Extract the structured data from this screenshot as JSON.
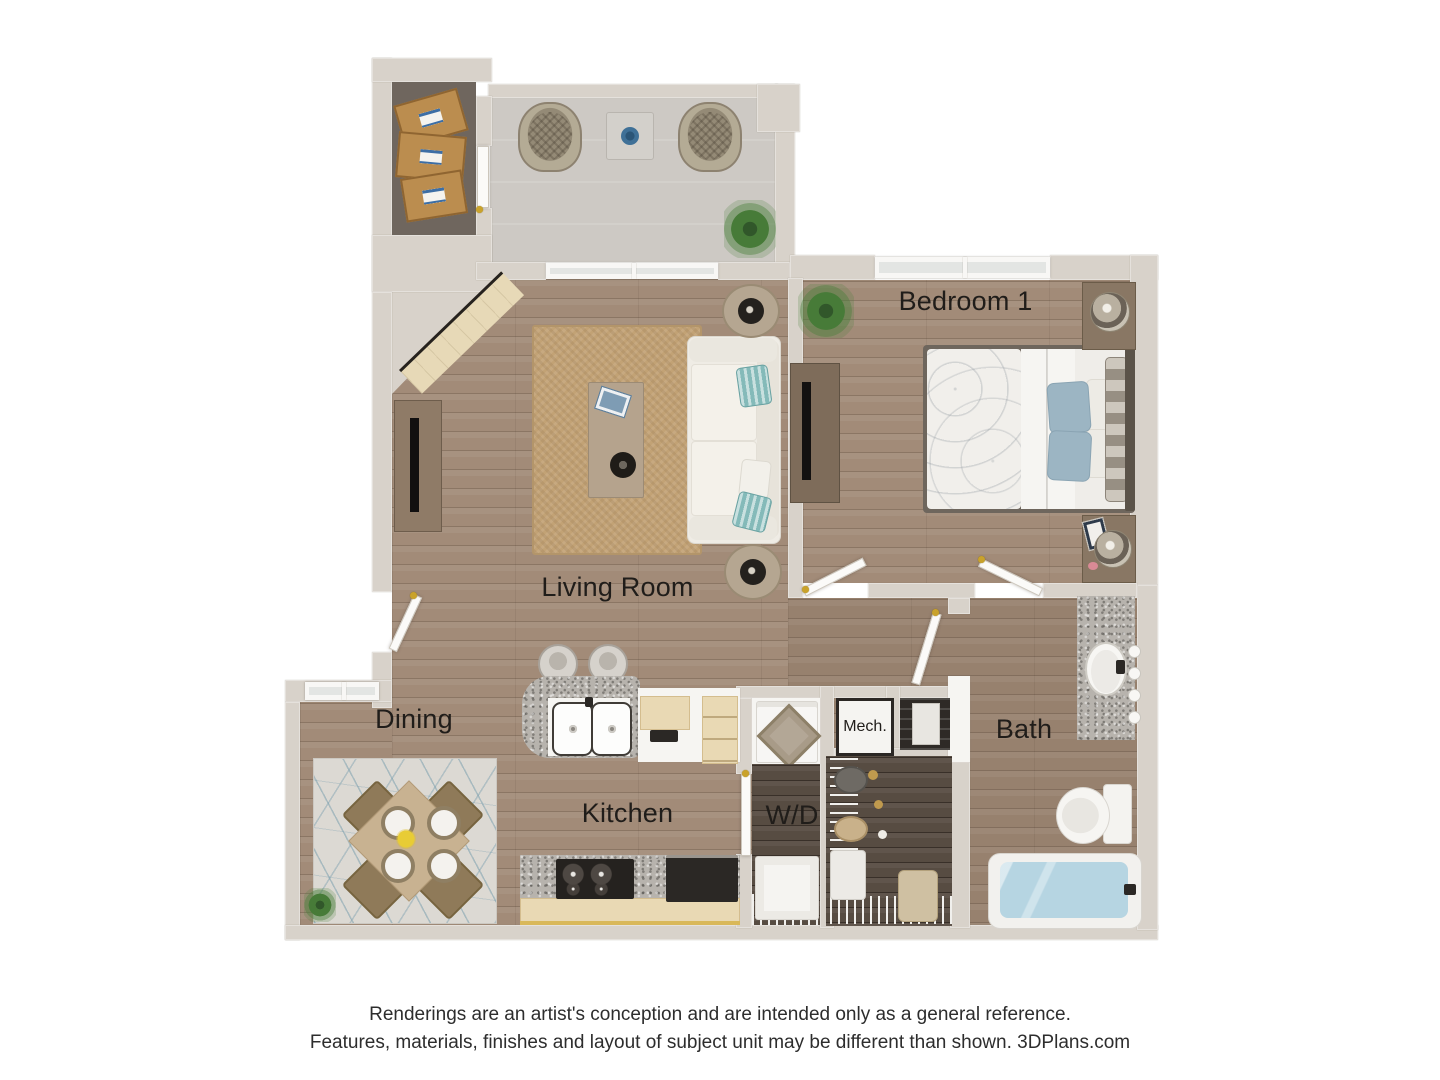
{
  "labels": {
    "bedroom1": "Bedroom 1",
    "living": "Living Room",
    "dining": "Dining",
    "kitchen": "Kitchen",
    "laundry": "W/D",
    "mechanical": "Mech.",
    "bath": "Bath"
  },
  "disclaimer": {
    "line1": "Renderings are an artist's conception and are intended only as a general reference.",
    "line2": "Features, materials, finishes and layout of subject unit may be different than shown. 3DPlans.com"
  },
  "colors": {
    "wall": "#d8d2ca",
    "wood_floor": "#a28b78",
    "wood_dark_closet": "#574c42",
    "patio_floor": "#cdc9c4",
    "storage_floor": "#6f665e",
    "jute_rug": "#c2a275",
    "dining_rug": "#dcd9d3",
    "granite_counter": "#b7b3ad",
    "cabinet_cream": "#e9d9b4",
    "pillow_blue": "#9cb5c3",
    "pillow_teal": "#84bab9",
    "tub_water": "#b6d5e2",
    "door_hinge_gold": "#c9a22b",
    "label_text": "#201d1a"
  }
}
